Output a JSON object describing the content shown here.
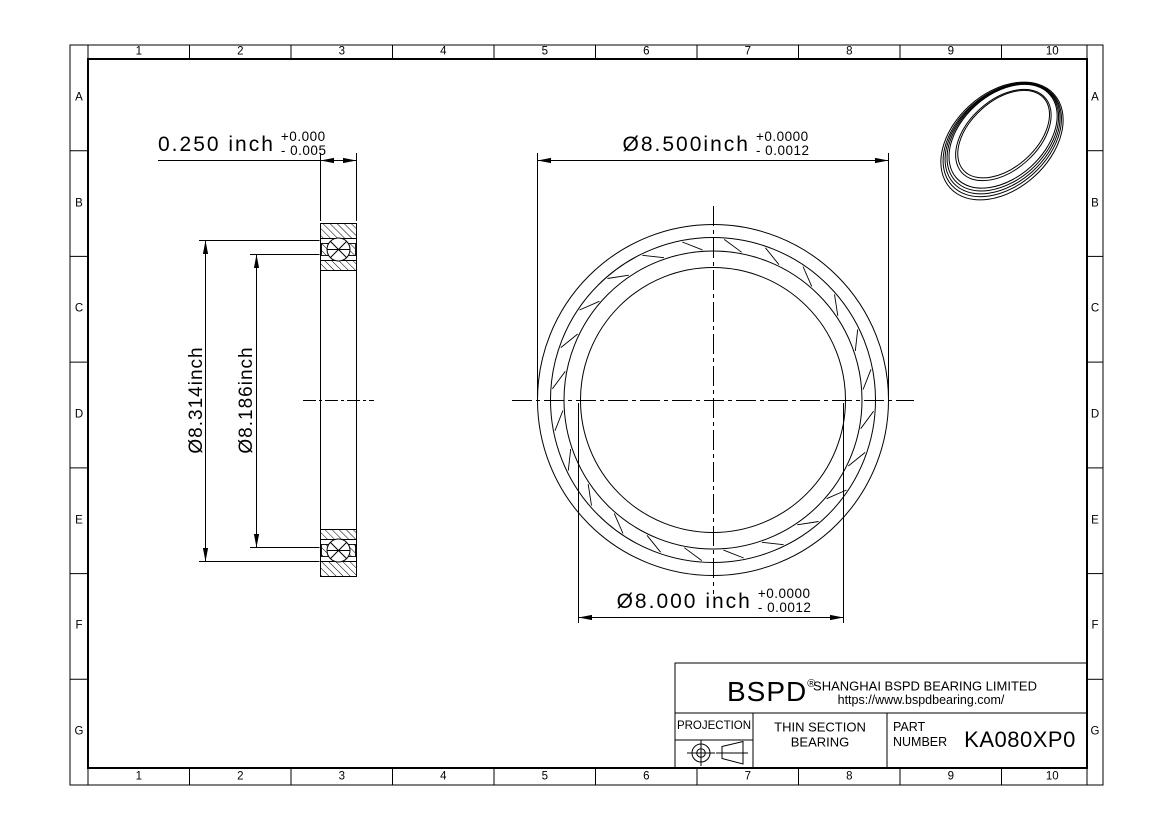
{
  "drawing": {
    "grid": {
      "cols": [
        "1",
        "2",
        "3",
        "4",
        "5",
        "6",
        "7",
        "8",
        "9",
        "10"
      ],
      "rows": [
        "A",
        "B",
        "C",
        "D",
        "E",
        "F",
        "G"
      ]
    },
    "dimensions": {
      "width": {
        "value": "0.250 inch",
        "tol_plus": "+0.000",
        "tol_minus": "- 0.005"
      },
      "outer_diameter": {
        "value": "Ø8.500inch",
        "tol_plus": "+0.0000",
        "tol_minus": "- 0.0012"
      },
      "bore_diameter": {
        "value": "Ø8.000 inch",
        "tol_plus": "+0.0000",
        "tol_minus": "- 0.0012"
      },
      "outer_raceway_diameter": {
        "value": "Ø8.314inch"
      },
      "inner_raceway_diameter": {
        "value": "Ø8.186inch"
      }
    },
    "title_block": {
      "logo": "BSPD",
      "registered_mark": "®",
      "company": "SHANGHAI BSPD BEARING LIMITED",
      "website": "https://www.bspdbearing.com/",
      "projection_label": "PROJECTION",
      "product_line1": "THIN SECTION",
      "product_line2": "BEARING",
      "part_label_line1": "PART",
      "part_label_line2": "NUMBER",
      "part_number": "KA080XP0"
    },
    "line_color": "#000000",
    "background": "#ffffff"
  }
}
